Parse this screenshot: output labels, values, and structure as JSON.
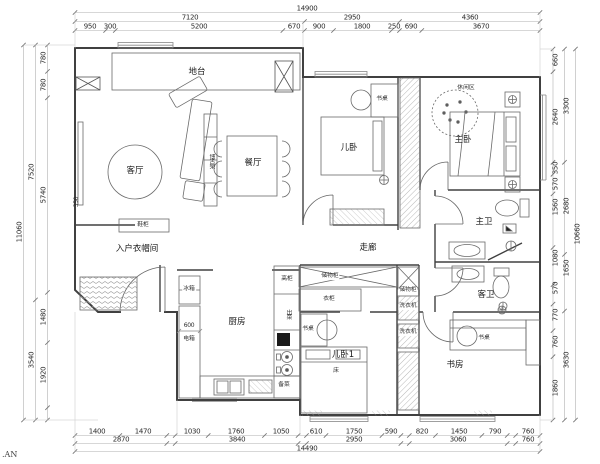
{
  "watermark": ".AN",
  "dimensions": {
    "top": {
      "total": "14900",
      "row2": [
        "7120",
        "2950",
        "4360"
      ],
      "row3": [
        "950",
        "300",
        "5200",
        "670",
        "900",
        "1800",
        "250",
        "690",
        "3670"
      ]
    },
    "bottom": {
      "row1": [
        "1400",
        "1470",
        "1030",
        "1760",
        "1050",
        "610",
        "1750",
        "590",
        "820",
        "1450",
        "790",
        "760"
      ],
      "row2": [
        "2870",
        "3840",
        "2950",
        "3060",
        "760"
      ],
      "total": "14490"
    },
    "left": {
      "inner": [
        "780",
        "780",
        "5740",
        "1480",
        "1920"
      ],
      "middle": [
        "7520",
        "3540"
      ],
      "total": "11060"
    },
    "right": {
      "inner": [
        "660",
        "2640",
        "350",
        "570",
        "1560",
        "1080",
        "570",
        "770",
        "760",
        "1860"
      ],
      "middle": [
        "3300",
        "2680",
        "1650",
        "3630"
      ],
      "total": "10660"
    },
    "inline": {
      "living": "350",
      "kitchen": "600"
    }
  },
  "labels": {
    "platform": "地台",
    "living": "客厅",
    "curio": "博古架",
    "dining": "餐厅",
    "kid_bedroom": "儿卧",
    "desk1": "书桌",
    "leisure": "休闲区",
    "master": "主卧",
    "corridor": "走廊",
    "master_bath": "主卫",
    "guest_bath": "客卫",
    "storage1": "储物柜",
    "wardrobe": "衣柜",
    "storage2": "储物柜",
    "washer1": "洗衣机",
    "washer2": "洗衣机",
    "cloakroom": "入户衣帽间",
    "shoe": "鞋柜",
    "fridge": "冰箱",
    "kitchen": "厨房",
    "elec": "电箱",
    "tall_cab": "高柜",
    "serve": "出菜",
    "prep": "备菜",
    "kid_bedroom1": "儿卧1",
    "bed": "床",
    "desk2": "书桌",
    "study": "书房",
    "desk3": "书桌"
  },
  "colors": {
    "wall": "#404040",
    "furniture": "#6a6a6a",
    "dimline": "#b0b0b0",
    "text": "#2b2b2b"
  }
}
